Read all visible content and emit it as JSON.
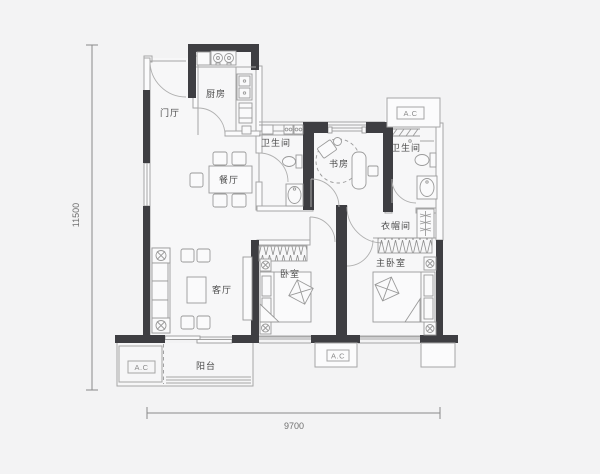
{
  "plan": {
    "title": "apartment-floor-plan",
    "rooms": {
      "entry": "门厅",
      "kitchen": "厨房",
      "dining": "餐厅",
      "bath1": "卫生间",
      "study": "书房",
      "bath2": "卫生间",
      "cloakroom": "衣帽间",
      "bedroom": "卧室",
      "master_bedroom": "主卧室",
      "living": "客厅",
      "balcony": "阳台"
    },
    "ac_units": {
      "top_right": "A.C",
      "bottom_left": "A.C",
      "bottom_middle": "A.C"
    },
    "dimensions": {
      "height_mm": "11500",
      "width_mm": "9700"
    },
    "colors": {
      "wall": "#3e3e42",
      "line": "#a6a6a6",
      "background": "#f3f3f4",
      "label_text": "#4b4b4b"
    }
  }
}
